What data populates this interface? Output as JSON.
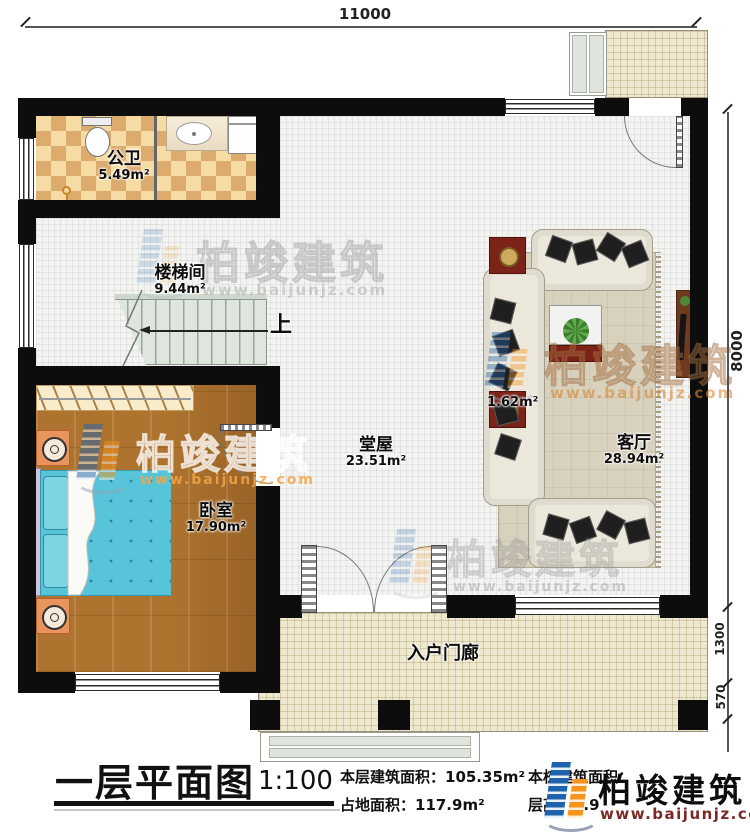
{
  "dimensions": {
    "top": "11000",
    "right_upper": "8000",
    "right_mid": "1300",
    "right_lower": "570"
  },
  "rooms": {
    "bathroom": {
      "name": "公卫",
      "area": "5.49m²"
    },
    "stairwell": {
      "name": "楼梯间",
      "area": "9.44m²"
    },
    "bedroom": {
      "name": "卧室",
      "area": "17.90m²"
    },
    "hall": {
      "name": "堂屋",
      "area": "23.51m²"
    },
    "living_room": {
      "name": "客厅",
      "area": "28.94m²"
    },
    "porch": {
      "name": "入户门廊"
    },
    "unnamed_area": {
      "area": "1.62m²"
    }
  },
  "stairs": {
    "up_label": "上"
  },
  "title_block": {
    "title": "一层平面图",
    "scale": "1:100",
    "floor_area_label": "本层建筑面积：105.35m²",
    "land_area_label": "占地面积：117.9m²",
    "building_area_label": "本栋建筑面积：",
    "height_label": "层高：3.9"
  },
  "brand": {
    "name": "柏竣建筑",
    "website": "www.baijunjz.com"
  },
  "watermark": {
    "name": "柏竣建筑",
    "website": "www.baijunjz.com"
  }
}
